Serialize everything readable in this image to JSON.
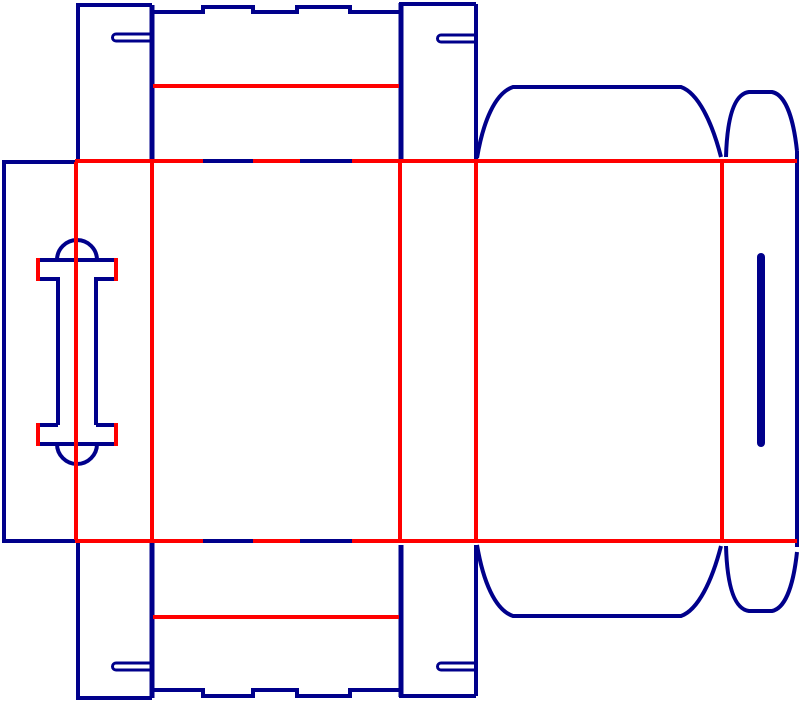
{
  "canvas": {
    "width": 800,
    "height": 704,
    "background": "#ffffff"
  },
  "legend": {
    "cut_color": "#00008B",
    "crease_color": "#FF0000"
  },
  "stroke": {
    "default": 4,
    "double_cut": 5,
    "slot": 3,
    "slot_bar": 8
  },
  "elements": [
    {
      "name": "glue-panel-left-edge",
      "layer": "cut",
      "d": "M 4 162 L 4 541"
    },
    {
      "name": "glue-panel-top-edge",
      "layer": "cut",
      "d": "M 2 162 L 76 162"
    },
    {
      "name": "glue-panel-bottom-edge",
      "layer": "cut",
      "d": "M 2 541 L 76 541"
    },
    {
      "name": "top-flap-a-left-edge",
      "layer": "cut",
      "d": "M 78 5 L 78 160"
    },
    {
      "name": "top-flap-a-top-edge",
      "layer": "cut",
      "d": "M 76 5 L 152 5"
    },
    {
      "name": "top-flap-a-right-edge",
      "layer": "cut",
      "d": "M 152 5 L 152 160",
      "w": 5
    },
    {
      "name": "top-flap-a-slot",
      "layer": "cut",
      "d": "M 151 34 L 116 34 A 3.5 3.5 0 0 0 116 41 L 151 41",
      "w": 3
    },
    {
      "name": "top-lid-outer-edge",
      "layer": "cut",
      "d": "M 152 12 L 203 12 L 203 7 L 253 7 L 253 12 L 297 12 L 297 7 L 350 7 L 350 12 L 401 12"
    },
    {
      "name": "top-center-shared-edge",
      "layer": "cut",
      "d": "M 401 3 L 401 160",
      "w": 5
    },
    {
      "name": "top-flap-b-top-edge",
      "layer": "cut",
      "d": "M 399 4 L 476 4"
    },
    {
      "name": "top-flap-b-right-edge",
      "layer": "cut",
      "d": "M 476 4 L 476 160"
    },
    {
      "name": "top-flap-b-slot",
      "layer": "cut",
      "d": "M 476 35 L 441 35 A 3.5 3.5 0 0 0 441 42 L 476 42",
      "w": 3
    },
    {
      "name": "top-dust-flap-outline",
      "layer": "cut",
      "d": "M 477 158 C 483 122 495 93 513 87 L 681 87 C 698 93 712 122 721 157"
    },
    {
      "name": "top-right-tab-outline",
      "layer": "cut",
      "d": "M 726 157 C 727 121 733 94 749 92 L 772 92 C 787 95 794 123 797 151"
    },
    {
      "name": "right-panel-right-edge",
      "layer": "cut",
      "d": "M 797 151 L 797 547"
    },
    {
      "name": "right-panel-slot-bar",
      "layer": "cut",
      "d": "M 761 257 L 761 443",
      "w": 8,
      "cap": "round"
    },
    {
      "name": "handle-top-bar-top-edge",
      "layer": "cut",
      "d": "M 38 260 L 116 260"
    },
    {
      "name": "handle-top-dome",
      "layer": "cut",
      "d": "M 57 260 A 20 20 0 0 1 97 260"
    },
    {
      "name": "handle-top-bar-bottom-left",
      "layer": "cut",
      "d": "M 38 279 L 58 279"
    },
    {
      "name": "handle-top-bar-bottom-right",
      "layer": "cut",
      "d": "M 96 279 L 116 279"
    },
    {
      "name": "handle-stem-left",
      "layer": "cut",
      "d": "M 58 277 L 58 425"
    },
    {
      "name": "handle-stem-right",
      "layer": "cut",
      "d": "M 96 277 L 96 425"
    },
    {
      "name": "handle-bottom-bar-top-left",
      "layer": "cut",
      "d": "M 38 425 L 58 425"
    },
    {
      "name": "handle-bottom-bar-top-right",
      "layer": "cut",
      "d": "M 96 425 L 116 425"
    },
    {
      "name": "handle-bottom-bar-bottom-edge",
      "layer": "cut",
      "d": "M 38 444 L 116 444"
    },
    {
      "name": "handle-bottom-dome",
      "layer": "cut",
      "d": "M 57 444 A 20 20 0 0 0 97 444"
    },
    {
      "name": "bottom-flap-a-left-edge",
      "layer": "cut",
      "d": "M 78 542 L 78 698"
    },
    {
      "name": "bottom-flap-a-bottom-edge",
      "layer": "cut",
      "d": "M 76 698 L 152 698"
    },
    {
      "name": "bottom-flap-a-right-edge",
      "layer": "cut",
      "d": "M 152 542 L 152 698",
      "w": 5
    },
    {
      "name": "bottom-flap-a-slot",
      "layer": "cut",
      "d": "M 151 663 L 116 663 A 3.5 3.5 0 0 0 116 670 L 151 670",
      "w": 3
    },
    {
      "name": "bottom-lid-outer-edge",
      "layer": "cut",
      "d": "M 152 690 L 203 690 L 203 696 L 253 696 L 253 690 L 297 690 L 297 696 L 350 696 L 350 690 L 401 690"
    },
    {
      "name": "bottom-center-shared-edge",
      "layer": "cut",
      "d": "M 401 545 L 401 697",
      "w": 5
    },
    {
      "name": "bottom-flap-b-bottom-edge",
      "layer": "cut",
      "d": "M 399 696 L 476 696"
    },
    {
      "name": "bottom-flap-b-right-edge",
      "layer": "cut",
      "d": "M 476 545 L 476 696"
    },
    {
      "name": "bottom-flap-b-slot",
      "layer": "cut",
      "d": "M 476 663 L 441 663 A 3.5 3.5 0 0 0 441 670 L 476 670",
      "w": 3
    },
    {
      "name": "bottom-dust-flap-outline",
      "layer": "cut",
      "d": "M 477 545 C 483 581 495 610 513 616 L 681 616 C 698 610 712 581 721 546"
    },
    {
      "name": "bottom-right-tab-outline",
      "layer": "cut",
      "d": "M 726 546 C 727 582 733 609 749 611 L 772 611 C 787 608 794 580 797 552"
    },
    {
      "name": "crease-horizontal-top",
      "layer": "crease",
      "d": "M 75 161 L 797 161"
    },
    {
      "name": "crease-horizontal-bottom",
      "layer": "crease",
      "d": "M 75 541 L 797 541"
    },
    {
      "name": "crease-vertical-1",
      "layer": "crease",
      "d": "M 76 162 L 76 540"
    },
    {
      "name": "crease-vertical-2",
      "layer": "crease",
      "d": "M 152 162 L 152 540"
    },
    {
      "name": "crease-vertical-3",
      "layer": "crease",
      "d": "M 400 162 L 400 540"
    },
    {
      "name": "crease-vertical-4",
      "layer": "crease",
      "d": "M 476 162 L 476 540"
    },
    {
      "name": "crease-vertical-5",
      "layer": "crease",
      "d": "M 722 162 L 722 540"
    },
    {
      "name": "top-lid-crease",
      "layer": "crease",
      "d": "M 153 86 L 399 86"
    },
    {
      "name": "bottom-lid-crease",
      "layer": "crease",
      "d": "M 153 617 L 399 617"
    },
    {
      "name": "handle-fold-top-left",
      "layer": "crease",
      "d": "M 38 258 L 38 281"
    },
    {
      "name": "handle-fold-top-right",
      "layer": "crease",
      "d": "M 116 258 L 116 281"
    },
    {
      "name": "handle-fold-bottom-left",
      "layer": "crease",
      "d": "M 38 423 L 38 446"
    },
    {
      "name": "handle-fold-bottom-right",
      "layer": "crease",
      "d": "M 116 423 L 116 446"
    },
    {
      "name": "crease-top-cut-dash-1",
      "layer": "cut-top",
      "d": "M 203 161 L 253 161"
    },
    {
      "name": "crease-top-cut-dash-2",
      "layer": "cut-top",
      "d": "M 300 161 L 352 161"
    },
    {
      "name": "crease-bottom-cut-dash-1",
      "layer": "cut-top",
      "d": "M 203 541 L 253 541"
    },
    {
      "name": "crease-bottom-cut-dash-2",
      "layer": "cut-top",
      "d": "M 300 541 L 352 541"
    }
  ]
}
